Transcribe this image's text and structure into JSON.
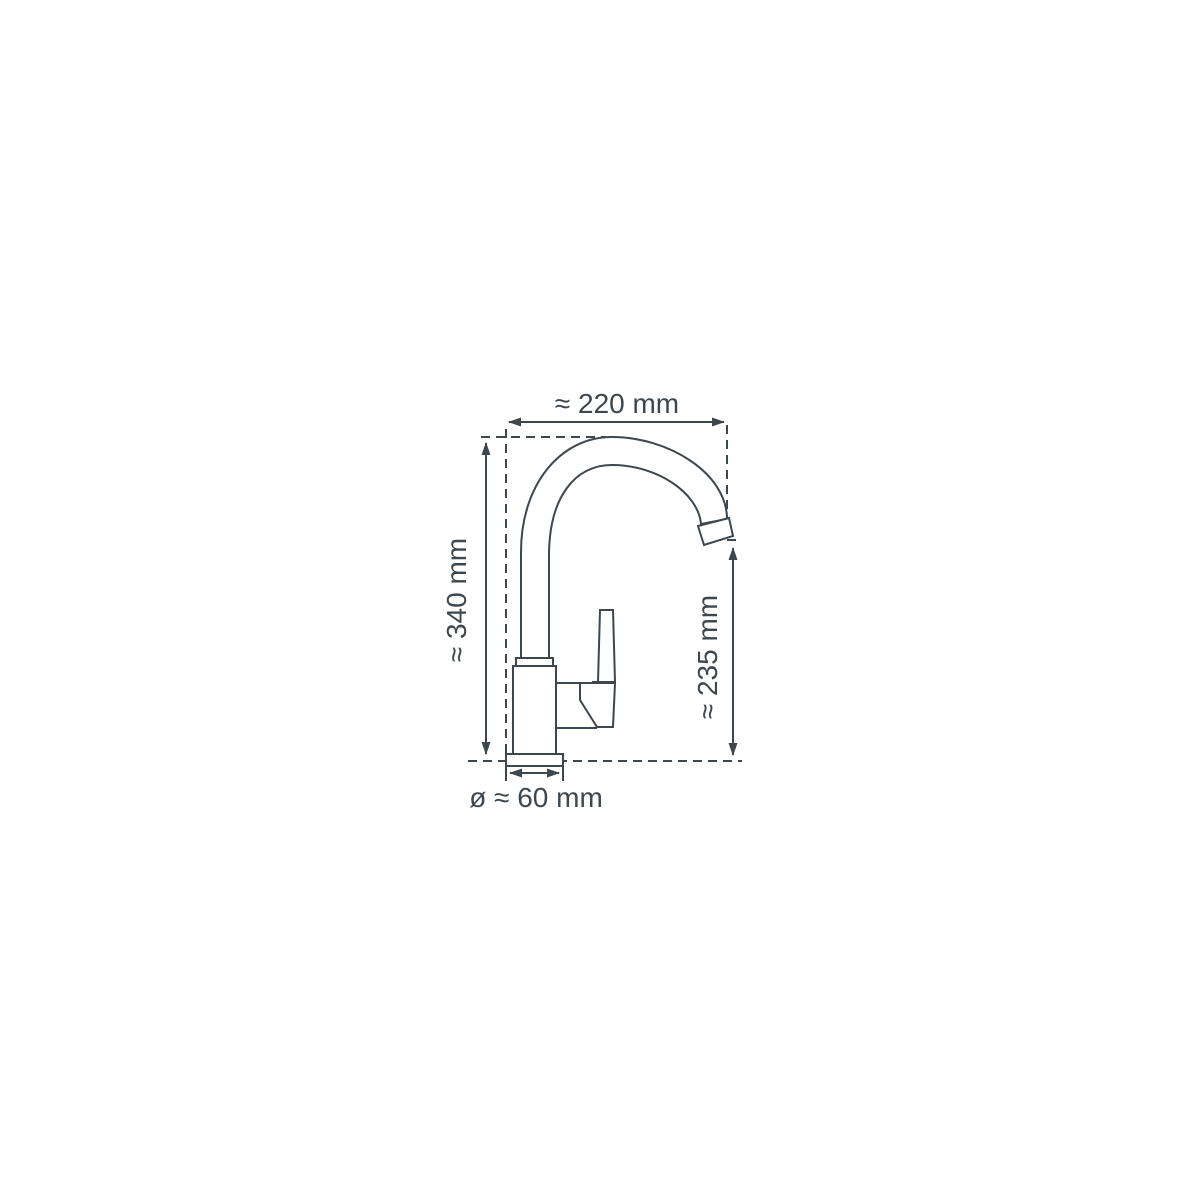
{
  "diagram": {
    "type": "technical-drawing",
    "subject": "single-lever kitchen faucet, side view with dimension lines",
    "dimensions": {
      "top_width": "≈ 220 mm",
      "left_height": "≈ 340 mm",
      "right_height": "≈ 235 mm",
      "base_diameter": "ø ≈ 60 mm"
    },
    "colors": {
      "line": "#3e464e",
      "background": "#ffffff"
    }
  }
}
